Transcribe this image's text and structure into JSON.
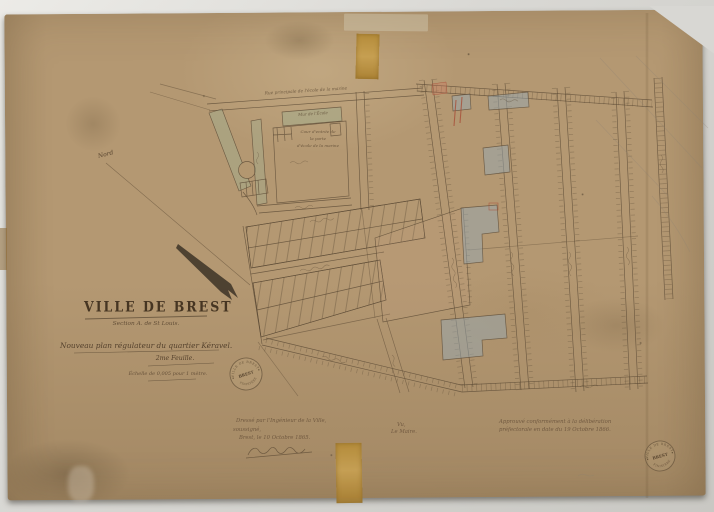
{
  "title_block": {
    "city": "VILLE DE BREST",
    "section": "Section A. de St Louis.",
    "subtitle": "Nouveau plan régulateur du quartier Kéravel.",
    "sheet": "2me Feuille.",
    "scale": "Échelle de 0,005 pour 1 mètre."
  },
  "map_labels": {
    "north": "Nord",
    "top_street": "Rue principale de l'école de la marine",
    "school_wall": "Mur de l'École",
    "courtyard": [
      "Cour d'entrée de",
      "la porte",
      "d'école de la marine"
    ]
  },
  "annotations": {
    "left": [
      "Dressé par l'Ingénieur de la Ville,",
      "soussigné,",
      "Brest, le 10 Octobre 1865."
    ],
    "center": [
      "Vu,",
      "Le Maire."
    ],
    "right": [
      "Approuvé conformément à la délibération",
      "préfectorale en date du 19 Octobre 1866."
    ]
  },
  "stamp": {
    "ring_top": "VILLE DE BREST",
    "center": "BREST",
    "ring_bottom": "FINISTÈRE"
  },
  "colors": {
    "paper": "#b49872",
    "ink": "#5d4b36",
    "wash_green": "#9fae90",
    "wash_blue": "#96a8b4",
    "accent_red": "#a84f38",
    "tape": "#b08a3a",
    "scanner_background": "#d9d8d4"
  }
}
